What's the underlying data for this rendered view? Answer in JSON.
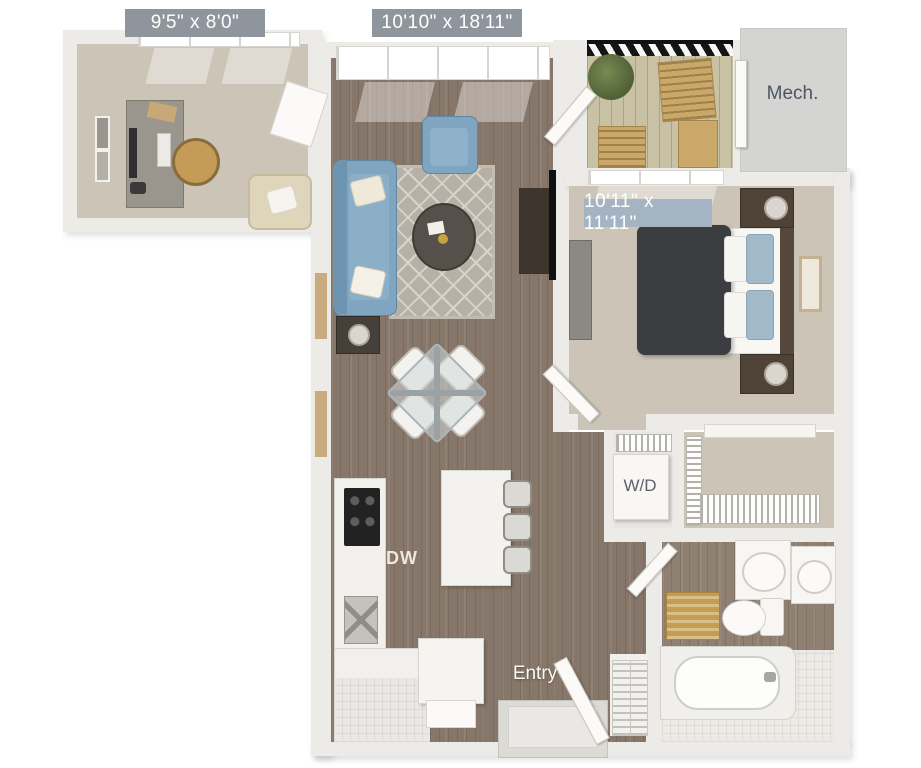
{
  "title": "apartment-floor-plan",
  "colors": {
    "wall_fill": "#ecebe7",
    "wall_edge": "#cfccc6",
    "wood_floor": "#87776a",
    "wood_floor_light": "#8f8071",
    "carpet": "#ccc5b7",
    "deck_wood": "#c8c1a4",
    "mech_floor": "#d4d4d2",
    "tile_floor": "#eceae5",
    "accent_blue": "#7fa5c0",
    "rug_base": "#b7b0a6",
    "rug_line": "#d9d4c9",
    "badge_gray": "#8f959c",
    "badge_blue": "#a5b4c3",
    "label_dark": "#4d5660",
    "duvet_dark": "#3b3d40",
    "mat_gold": "#c49d4e",
    "balcony_wood": "#c9a86a",
    "furn_wood": "#4f4337"
  },
  "labels": {
    "office_dims": "9'5\" x 8'0\"",
    "living_dims": "10'10\" x 18'11\"",
    "bedroom_dims": "10'11\" x 11'11\"",
    "mech": "Mech.",
    "washer_dryer": "W/D",
    "dishwasher": "DW",
    "entry": "Entry"
  }
}
